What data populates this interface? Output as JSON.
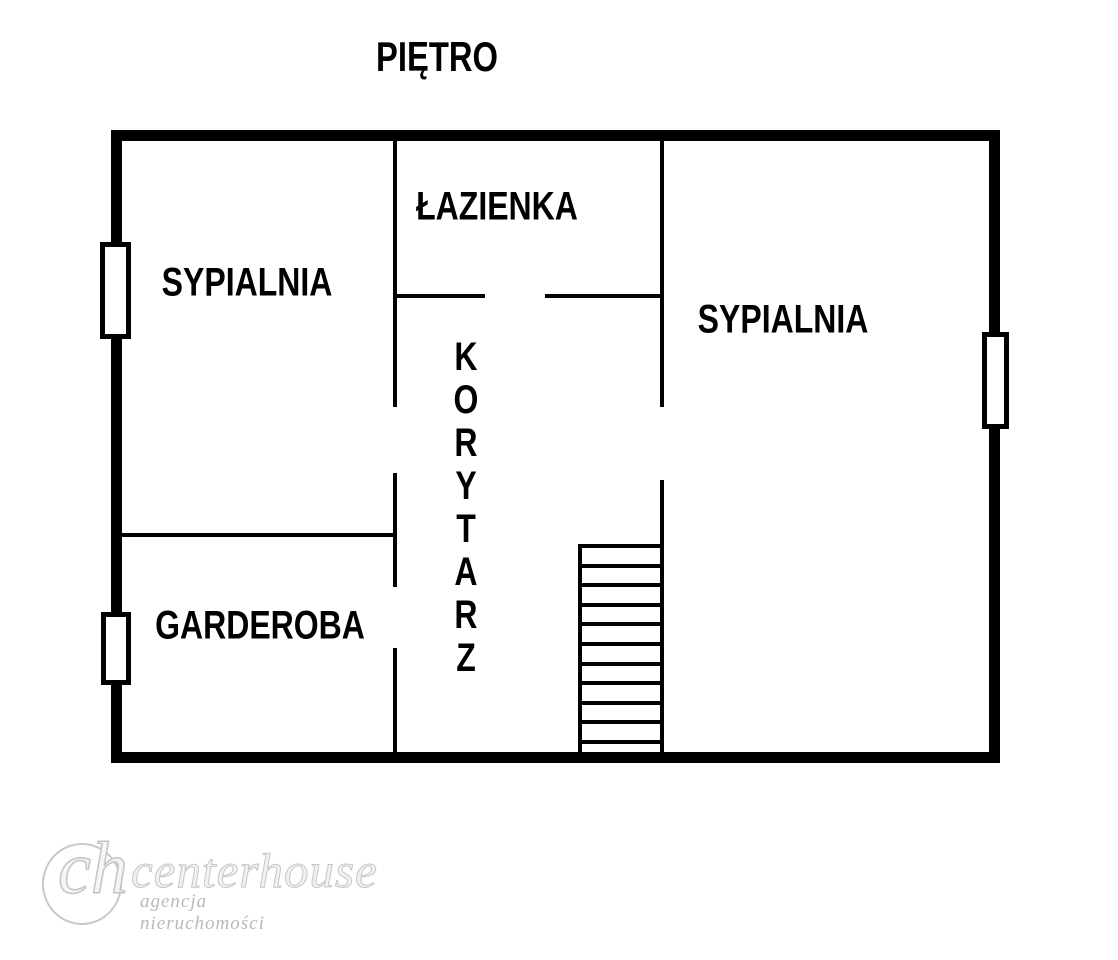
{
  "title": "PIĘTRO",
  "rooms": {
    "sypialnia_left": "SYPIALNIA",
    "lazienka": "ŁAZIENKA",
    "sypialnia_right": "SYPIALNIA",
    "korytarz": "KORYTARZ",
    "garderoba": "GARDEROBA"
  },
  "stairs": {
    "steps": 11
  },
  "logo": {
    "monogram": "ch",
    "name": "centerhouse",
    "tagline": "agencja nieruchomości"
  },
  "colors": {
    "wall": "#000000",
    "background": "#ffffff",
    "watermark": "#c9c9c9"
  }
}
